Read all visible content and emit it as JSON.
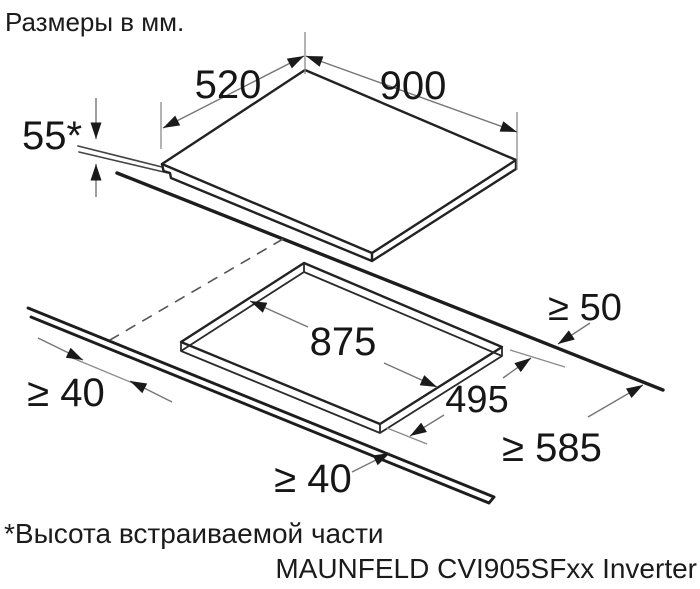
{
  "page": {
    "title": "Размеры в мм.",
    "footnote": "*Высота встраиваемой части",
    "model": "MAUNFELD CVI905SFxx Inverter"
  },
  "dimensions": {
    "hob_width": "900",
    "hob_depth": "520",
    "builtin_height": "55*",
    "cutout_width": "875",
    "cutout_depth": "495",
    "clearance_rear": "≥ 50",
    "clearance_side": "≥ 40",
    "clearance_front": "≥ 40",
    "worktop_depth_min": "≥ 585"
  }
}
